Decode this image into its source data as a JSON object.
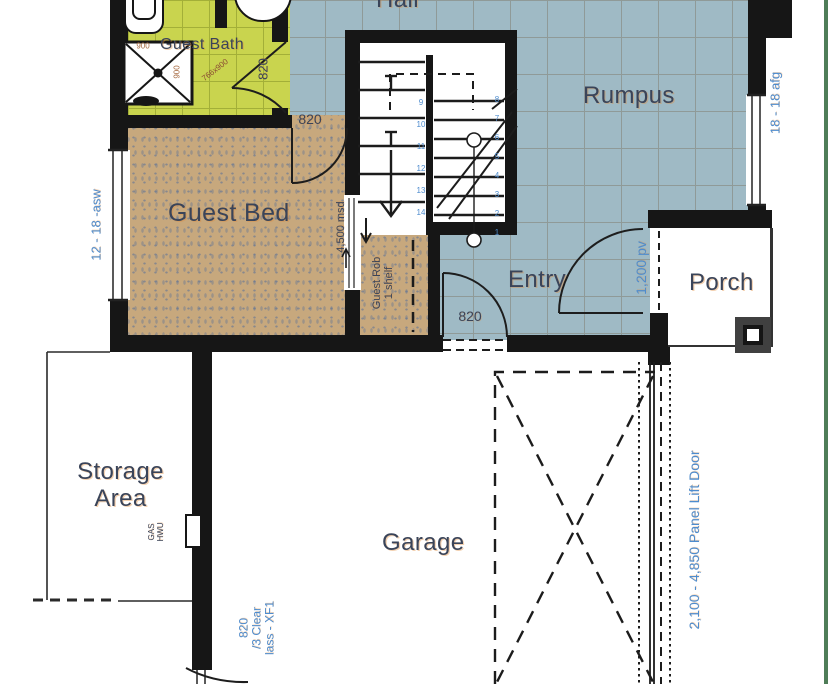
{
  "colors": {
    "tile_blue": "#9fbac5",
    "tile_grout": "#8f9a98",
    "bath_green": "#c9d44e",
    "bath_grout": "#a3af38",
    "carpet_tan": "#c7a87d",
    "wall_black": "#161616",
    "label_navy": "#3a4459",
    "dim_blue": "#4e8cce",
    "dim_brown": "#a5683f",
    "page_green": "#4f7d58"
  },
  "rooms": {
    "hall": "Hall",
    "guest_bath": "Guest Bath",
    "rumpus": "Rumpus",
    "guest_bed": "Guest Bed",
    "entry": "Entry",
    "porch": "Porch",
    "storage_area": "Storage Area",
    "garage": "Garage",
    "guest_robe_line1": "Guest Rob",
    "guest_robe_line2": "1 shelf"
  },
  "dimensions": {
    "bath_door": "820",
    "bed_door": "820",
    "entry_door": "820",
    "shower_width": "900",
    "shower_depth": "900",
    "bath_door_diag": "766x900",
    "left_window": "12 - 18 -asw",
    "right_window": "18 - 18 afg",
    "robe_sliding_door": "4,500 msd",
    "front_door": "1,200 pv",
    "garage_lift_door": "2,100 - 4,850 Panel Lift Door",
    "garage_window_line1": "820",
    "garage_window_line2": "/3 Clear",
    "garage_window_line3": "lass - XF1",
    "hwu_line1": "GAS",
    "hwu_line2": "HWU"
  },
  "stairs": {
    "right_flight_numbers": [
      "8",
      "7",
      "6",
      "5",
      "4",
      "3",
      "2",
      "1"
    ],
    "left_flight_numbers": [
      "9",
      "10",
      "11",
      "12",
      "13",
      "14"
    ]
  }
}
